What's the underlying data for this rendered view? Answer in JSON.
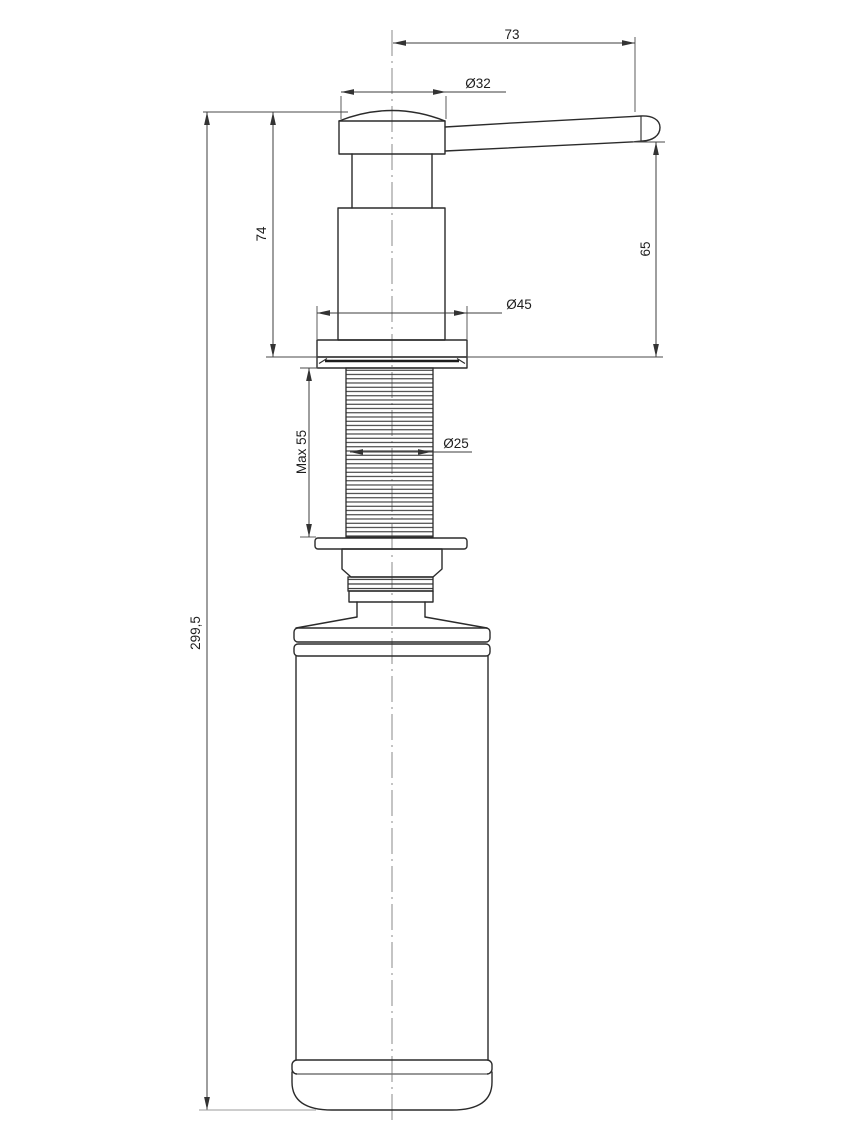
{
  "drawing": {
    "dimensions": {
      "spout_projection": "73",
      "head_diameter": "Ø32",
      "pump_height": "74",
      "spout_height": "65",
      "flange_diameter": "Ø45",
      "thread_length_max": "Max 55",
      "thread_diameter": "Ø25",
      "overall_height": "299,5"
    },
    "colors": {
      "background": "#ffffff",
      "outline": "#2b2b2b",
      "dimension_lines": "#3c3c3c",
      "centerline": "#a5a5a5"
    }
  }
}
